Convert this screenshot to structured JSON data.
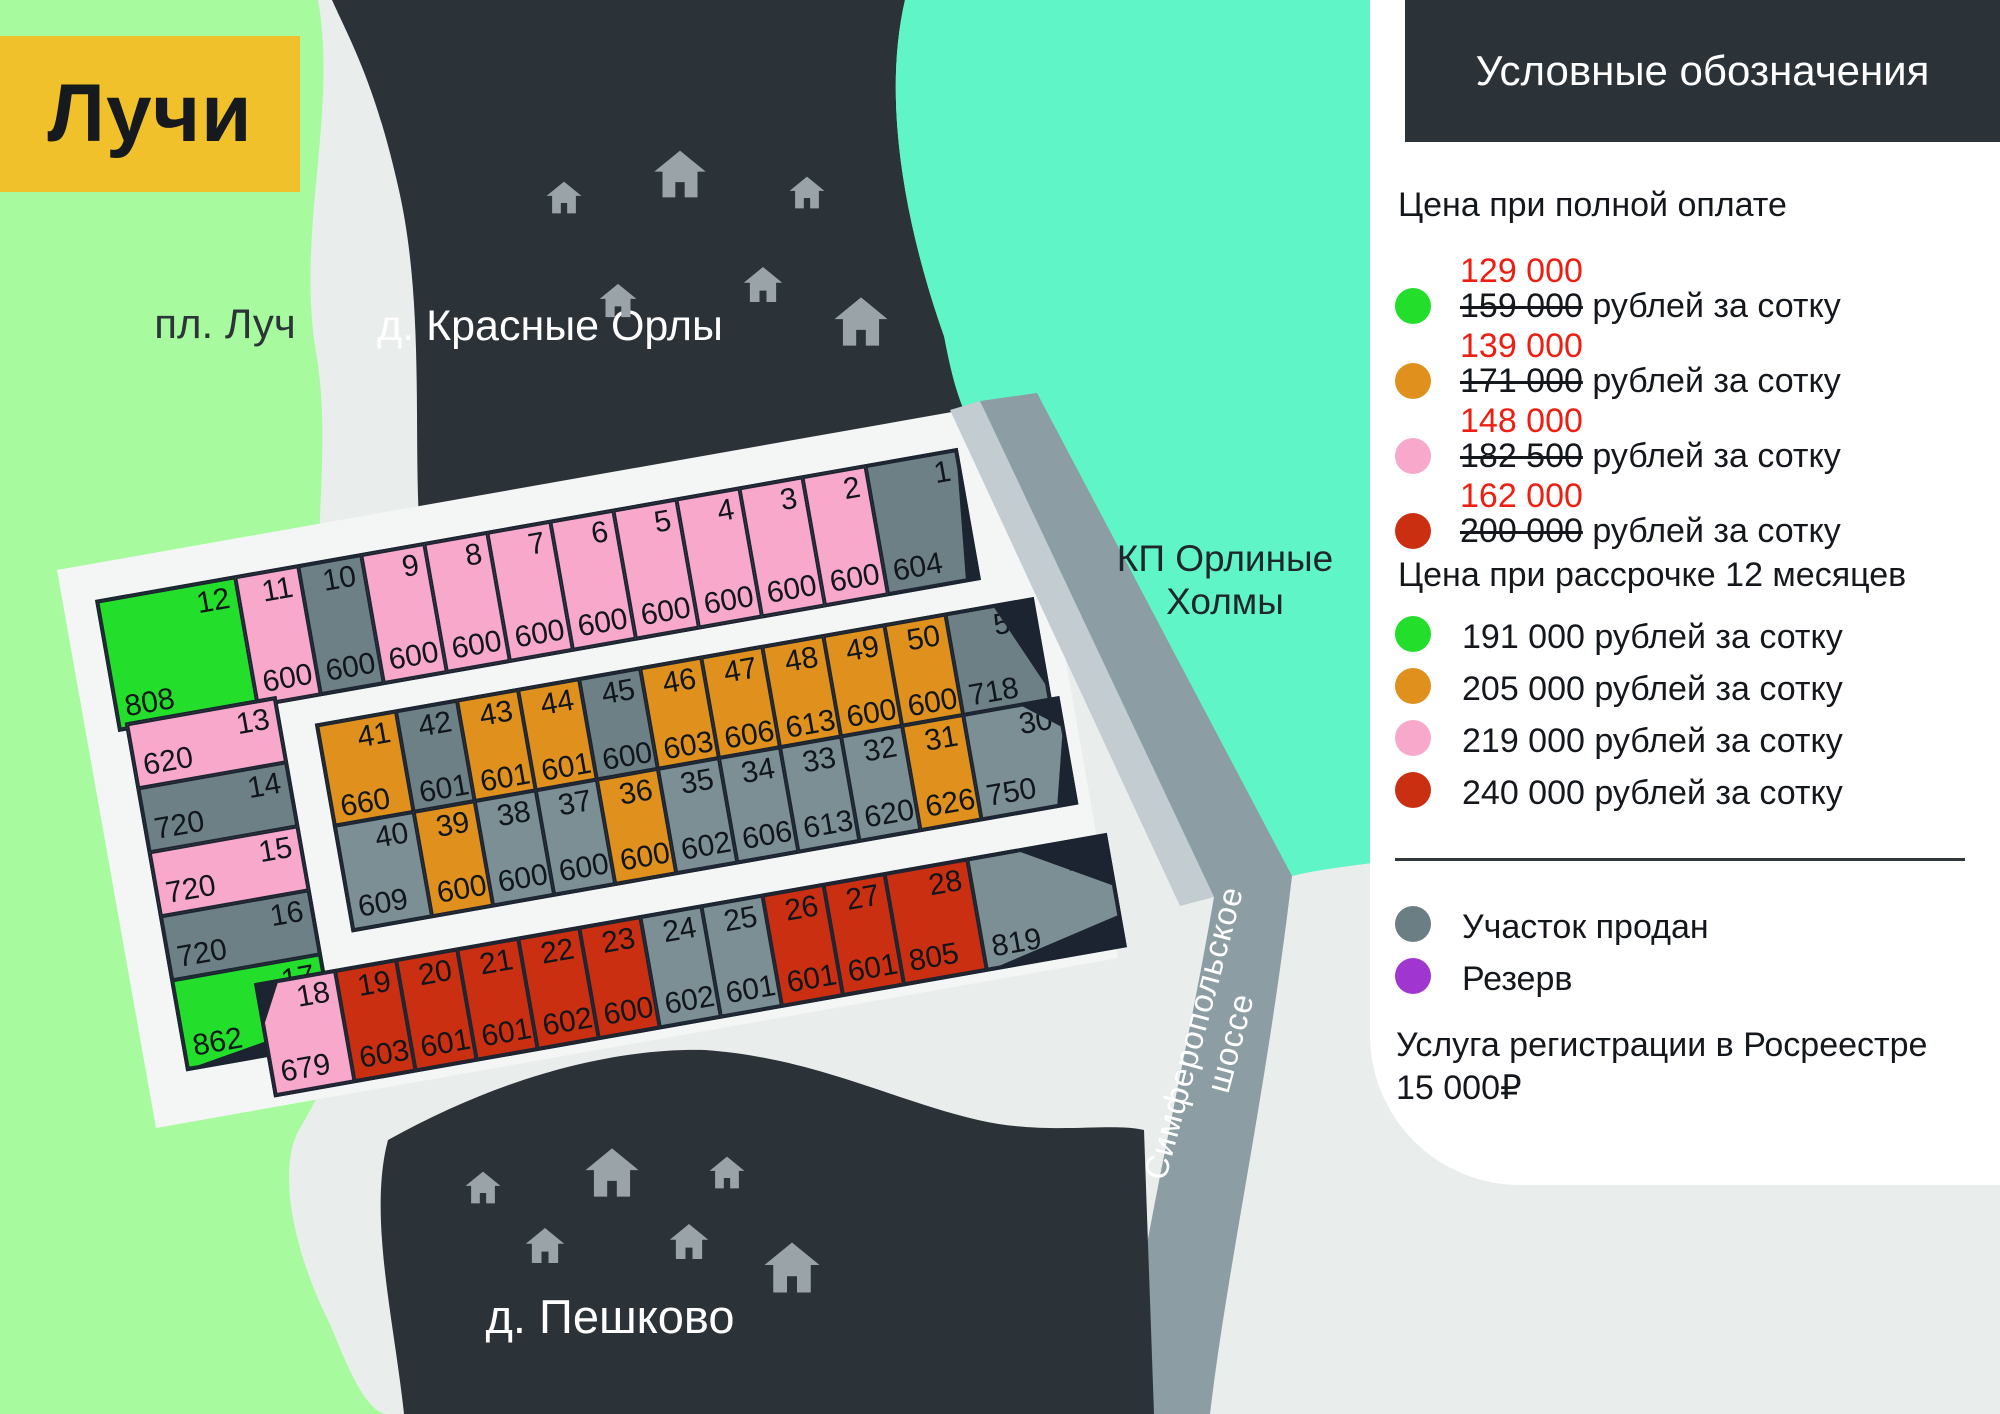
{
  "title": "Лучи",
  "map_labels": {
    "left_area": "пл. Луч",
    "top_village": "д. Красные Орлы",
    "bottom_village": "д. Пешково",
    "right_area_line1": "КП Орлиные",
    "right_area_line2": "Холмы",
    "road": "Симферопольское шоссе"
  },
  "colors": {
    "green": "#23df2c",
    "orange": "#e0911d",
    "pink": "#f8a8cb",
    "red": "#cb2f12",
    "sold_gray": "#6d8085",
    "sold_gray2": "#7c8f94",
    "reserve_purple": "#a135cf",
    "accent_yellow": "#f0c12a",
    "dark": "#2b3238",
    "teal": "#5ff5c7",
    "light_green": "#a7fb9e",
    "road_gray": "#8c9da3",
    "price_red": "#ec1f12"
  },
  "legend": {
    "title": "Условные обозначения",
    "full_payment": {
      "heading": "Цена при полной оплате",
      "items": [
        {
          "color": "#23df2c",
          "new_price": "129 000",
          "old_price": "159 000",
          "tail": " рублей за сотку"
        },
        {
          "color": "#e0911d",
          "new_price": "139 000",
          "old_price": "171 000",
          "tail": " рублей за сотку"
        },
        {
          "color": "#f8a8cb",
          "new_price": "148 000",
          "old_price": "182 500",
          "tail": " рублей за сотку"
        },
        {
          "color": "#cb2f12",
          "new_price": "162 000",
          "old_price": "200 000",
          "tail": " рублей за сотку"
        }
      ]
    },
    "installment": {
      "heading": "Цена при рассрочке 12 месяцев",
      "items": [
        {
          "color": "#23df2c",
          "label": "191 000 рублей за сотку"
        },
        {
          "color": "#e0911d",
          "label": "205 000 рублей за сотку"
        },
        {
          "color": "#f8a8cb",
          "label": "219 000 рублей за сотку"
        },
        {
          "color": "#cb2f12",
          "label": "240 000 рублей за сотку"
        }
      ]
    },
    "statuses": [
      {
        "color": "#6b7e84",
        "label": "Участок продан"
      },
      {
        "color": "#a135cf",
        "label": "Резерв"
      }
    ],
    "note_line1": "Услуга регистрации в Росреестре",
    "note_line2": "15 000₽"
  },
  "plots": {
    "rowA": [
      {
        "n": "12",
        "area": "808",
        "color": "green"
      },
      {
        "n": "11",
        "area": "600",
        "color": "pink"
      },
      {
        "n": "10",
        "area": "600",
        "color": "gray"
      },
      {
        "n": "9",
        "area": "600",
        "color": "pink"
      },
      {
        "n": "8",
        "area": "600",
        "color": "pink"
      },
      {
        "n": "7",
        "area": "600",
        "color": "pink"
      },
      {
        "n": "6",
        "area": "600",
        "color": "pink"
      },
      {
        "n": "5",
        "area": "600",
        "color": "pink"
      },
      {
        "n": "4",
        "area": "600",
        "color": "pink"
      },
      {
        "n": "3",
        "area": "600",
        "color": "pink"
      },
      {
        "n": "2",
        "area": "600",
        "color": "pink"
      },
      {
        "n": "1",
        "area": "604",
        "color": "gray"
      }
    ],
    "leftCol": [
      {
        "n": "13",
        "area": "620",
        "color": "pink"
      },
      {
        "n": "14",
        "area": "720",
        "color": "gray"
      },
      {
        "n": "15",
        "area": "720",
        "color": "pink"
      },
      {
        "n": "16",
        "area": "720",
        "color": "gray"
      },
      {
        "n": "17",
        "area": "862",
        "color": "green"
      }
    ],
    "rowB": [
      {
        "n": "41",
        "area": "660",
        "color": "orange"
      },
      {
        "n": "42",
        "area": "601",
        "color": "gray"
      },
      {
        "n": "43",
        "area": "601",
        "color": "orange"
      },
      {
        "n": "44",
        "area": "601",
        "color": "orange"
      },
      {
        "n": "45",
        "area": "600",
        "color": "gray"
      },
      {
        "n": "46",
        "area": "603",
        "color": "orange"
      },
      {
        "n": "47",
        "area": "606",
        "color": "orange"
      },
      {
        "n": "48",
        "area": "613",
        "color": "orange"
      },
      {
        "n": "49",
        "area": "600",
        "color": "orange"
      },
      {
        "n": "50",
        "area": "600",
        "color": "orange"
      },
      {
        "n": "51",
        "area": "718",
        "color": "gray"
      }
    ],
    "rowC": [
      {
        "n": "40",
        "area": "609",
        "color": "gray2"
      },
      {
        "n": "39",
        "area": "600",
        "color": "orange"
      },
      {
        "n": "38",
        "area": "600",
        "color": "gray2"
      },
      {
        "n": "37",
        "area": "600",
        "color": "gray2"
      },
      {
        "n": "36",
        "area": "600",
        "color": "orange"
      },
      {
        "n": "35",
        "area": "602",
        "color": "gray2"
      },
      {
        "n": "34",
        "area": "606",
        "color": "gray2"
      },
      {
        "n": "33",
        "area": "613",
        "color": "gray2"
      },
      {
        "n": "32",
        "area": "620",
        "color": "gray2"
      },
      {
        "n": "31",
        "area": "626",
        "color": "orange"
      },
      {
        "n": "30",
        "area": "750",
        "color": "gray2"
      }
    ],
    "rowD": [
      {
        "n": "18",
        "area": "679",
        "color": "pink"
      },
      {
        "n": "19",
        "area": "603",
        "color": "red"
      },
      {
        "n": "20",
        "area": "601",
        "color": "red"
      },
      {
        "n": "21",
        "area": "601",
        "color": "red"
      },
      {
        "n": "22",
        "area": "602",
        "color": "red"
      },
      {
        "n": "23",
        "area": "600",
        "color": "red"
      },
      {
        "n": "24",
        "area": "602",
        "color": "gray2"
      },
      {
        "n": "25",
        "area": "601",
        "color": "gray2"
      },
      {
        "n": "26",
        "area": "601",
        "color": "red"
      },
      {
        "n": "27",
        "area": "601",
        "color": "red"
      },
      {
        "n": "28",
        "area": "805",
        "color": "red"
      },
      {
        "n": "29",
        "area": "819",
        "color": "gray2"
      }
    ]
  }
}
